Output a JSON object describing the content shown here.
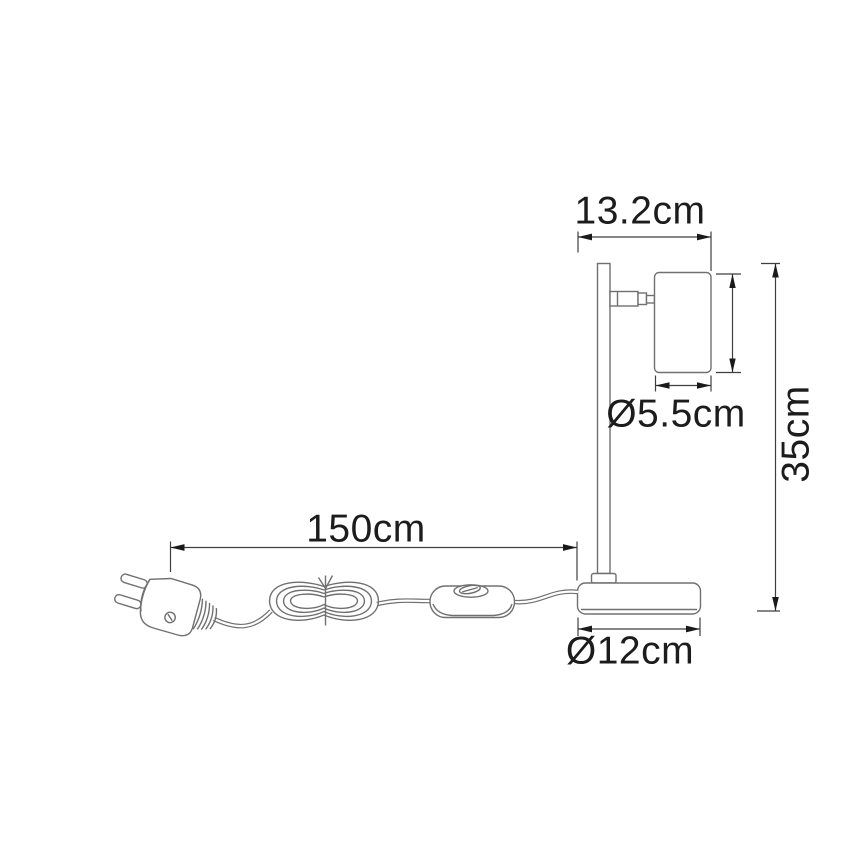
{
  "diagram": {
    "labels": {
      "top_width": "13.2cm",
      "head_diameter": "Ø5.5cm",
      "total_height": "35cm",
      "cable_length": "150cm",
      "base_diameter": "Ø12cm"
    },
    "colors": {
      "background": "#ffffff",
      "outline": "#707070",
      "dimension_lines": "#3f3f3f",
      "text": "#1c1c1c"
    }
  }
}
